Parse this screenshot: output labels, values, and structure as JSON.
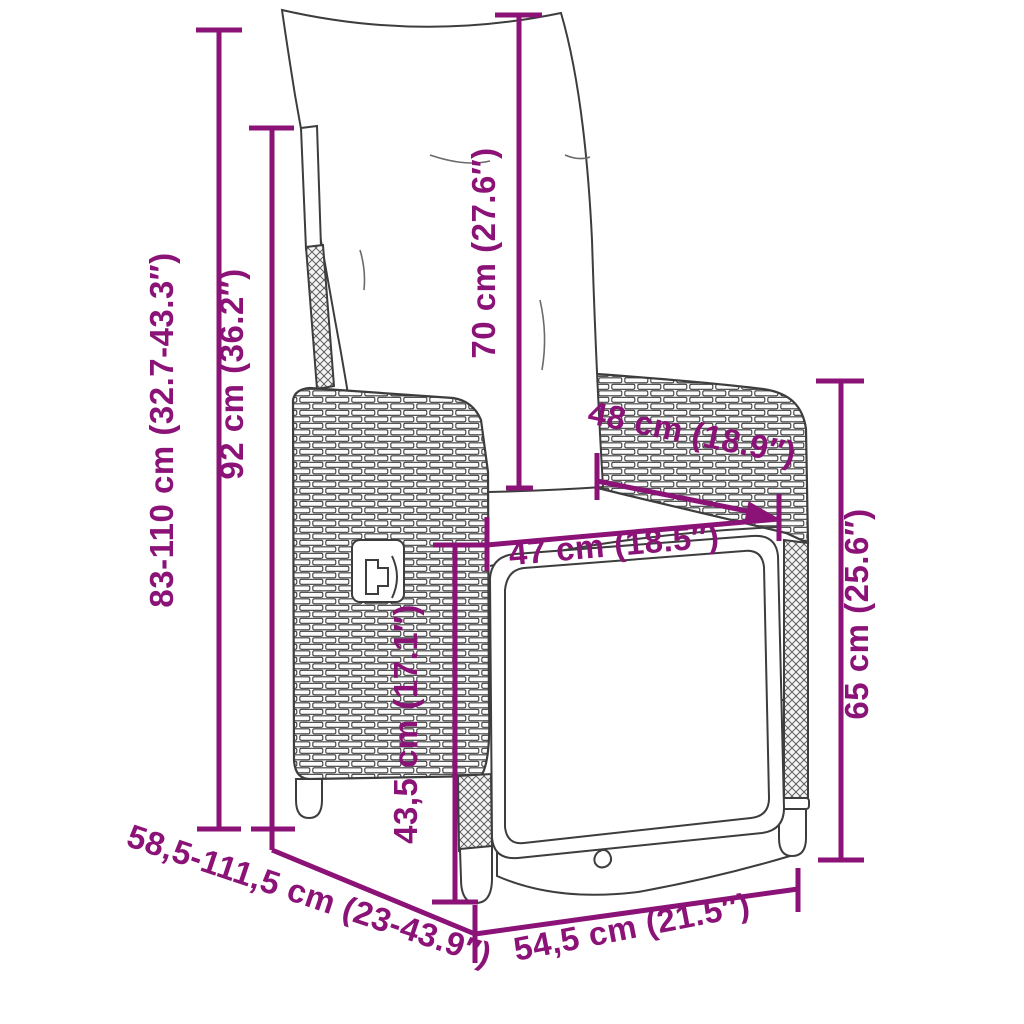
{
  "diagram": {
    "kind": "product-dimension-diagram",
    "product": "reclining-garden-chair-poly-rattan",
    "accent_color": "#8B1277",
    "line_color": "#3D3D3D",
    "background_color": "#FFFFFF",
    "units": [
      "cm",
      "inches"
    ],
    "dimensions": [
      {
        "id": "adjustable-height-range",
        "label": "83-110 cm (32.7-43.3″)",
        "cm": "83-110",
        "inches": "32.7-43.3",
        "orientation": "vertical"
      },
      {
        "id": "backrest-height",
        "label": "92 cm (36.2″)",
        "cm": "92",
        "inches": "36.2",
        "orientation": "vertical"
      },
      {
        "id": "back-cushion-height",
        "label": "70 cm (27.6″)",
        "cm": "70",
        "inches": "27.6",
        "orientation": "vertical"
      },
      {
        "id": "armrest-depth",
        "label": "48 cm (18.9″)",
        "cm": "48",
        "inches": "18.9",
        "orientation": "diagonal"
      },
      {
        "id": "seat-width",
        "label": "47 cm (18.5″)",
        "cm": "47",
        "inches": "18.5",
        "orientation": "horizontal"
      },
      {
        "id": "armrest-height",
        "label": "65 cm (25.6″)",
        "cm": "65",
        "inches": "25.6",
        "orientation": "vertical"
      },
      {
        "id": "seat-height",
        "label": "43,5 cm (17.1″)",
        "cm": "43,5",
        "inches": "17.1",
        "orientation": "vertical"
      },
      {
        "id": "adjustable-depth-range",
        "label": "58,5-111,5 cm (23-43.9″)",
        "cm": "58,5-111,5",
        "inches": "23-43.9",
        "orientation": "diagonal"
      },
      {
        "id": "base-width",
        "label": "54,5 cm (21.5″)",
        "cm": "54,5",
        "inches": "21.5",
        "orientation": "diagonal"
      }
    ]
  }
}
